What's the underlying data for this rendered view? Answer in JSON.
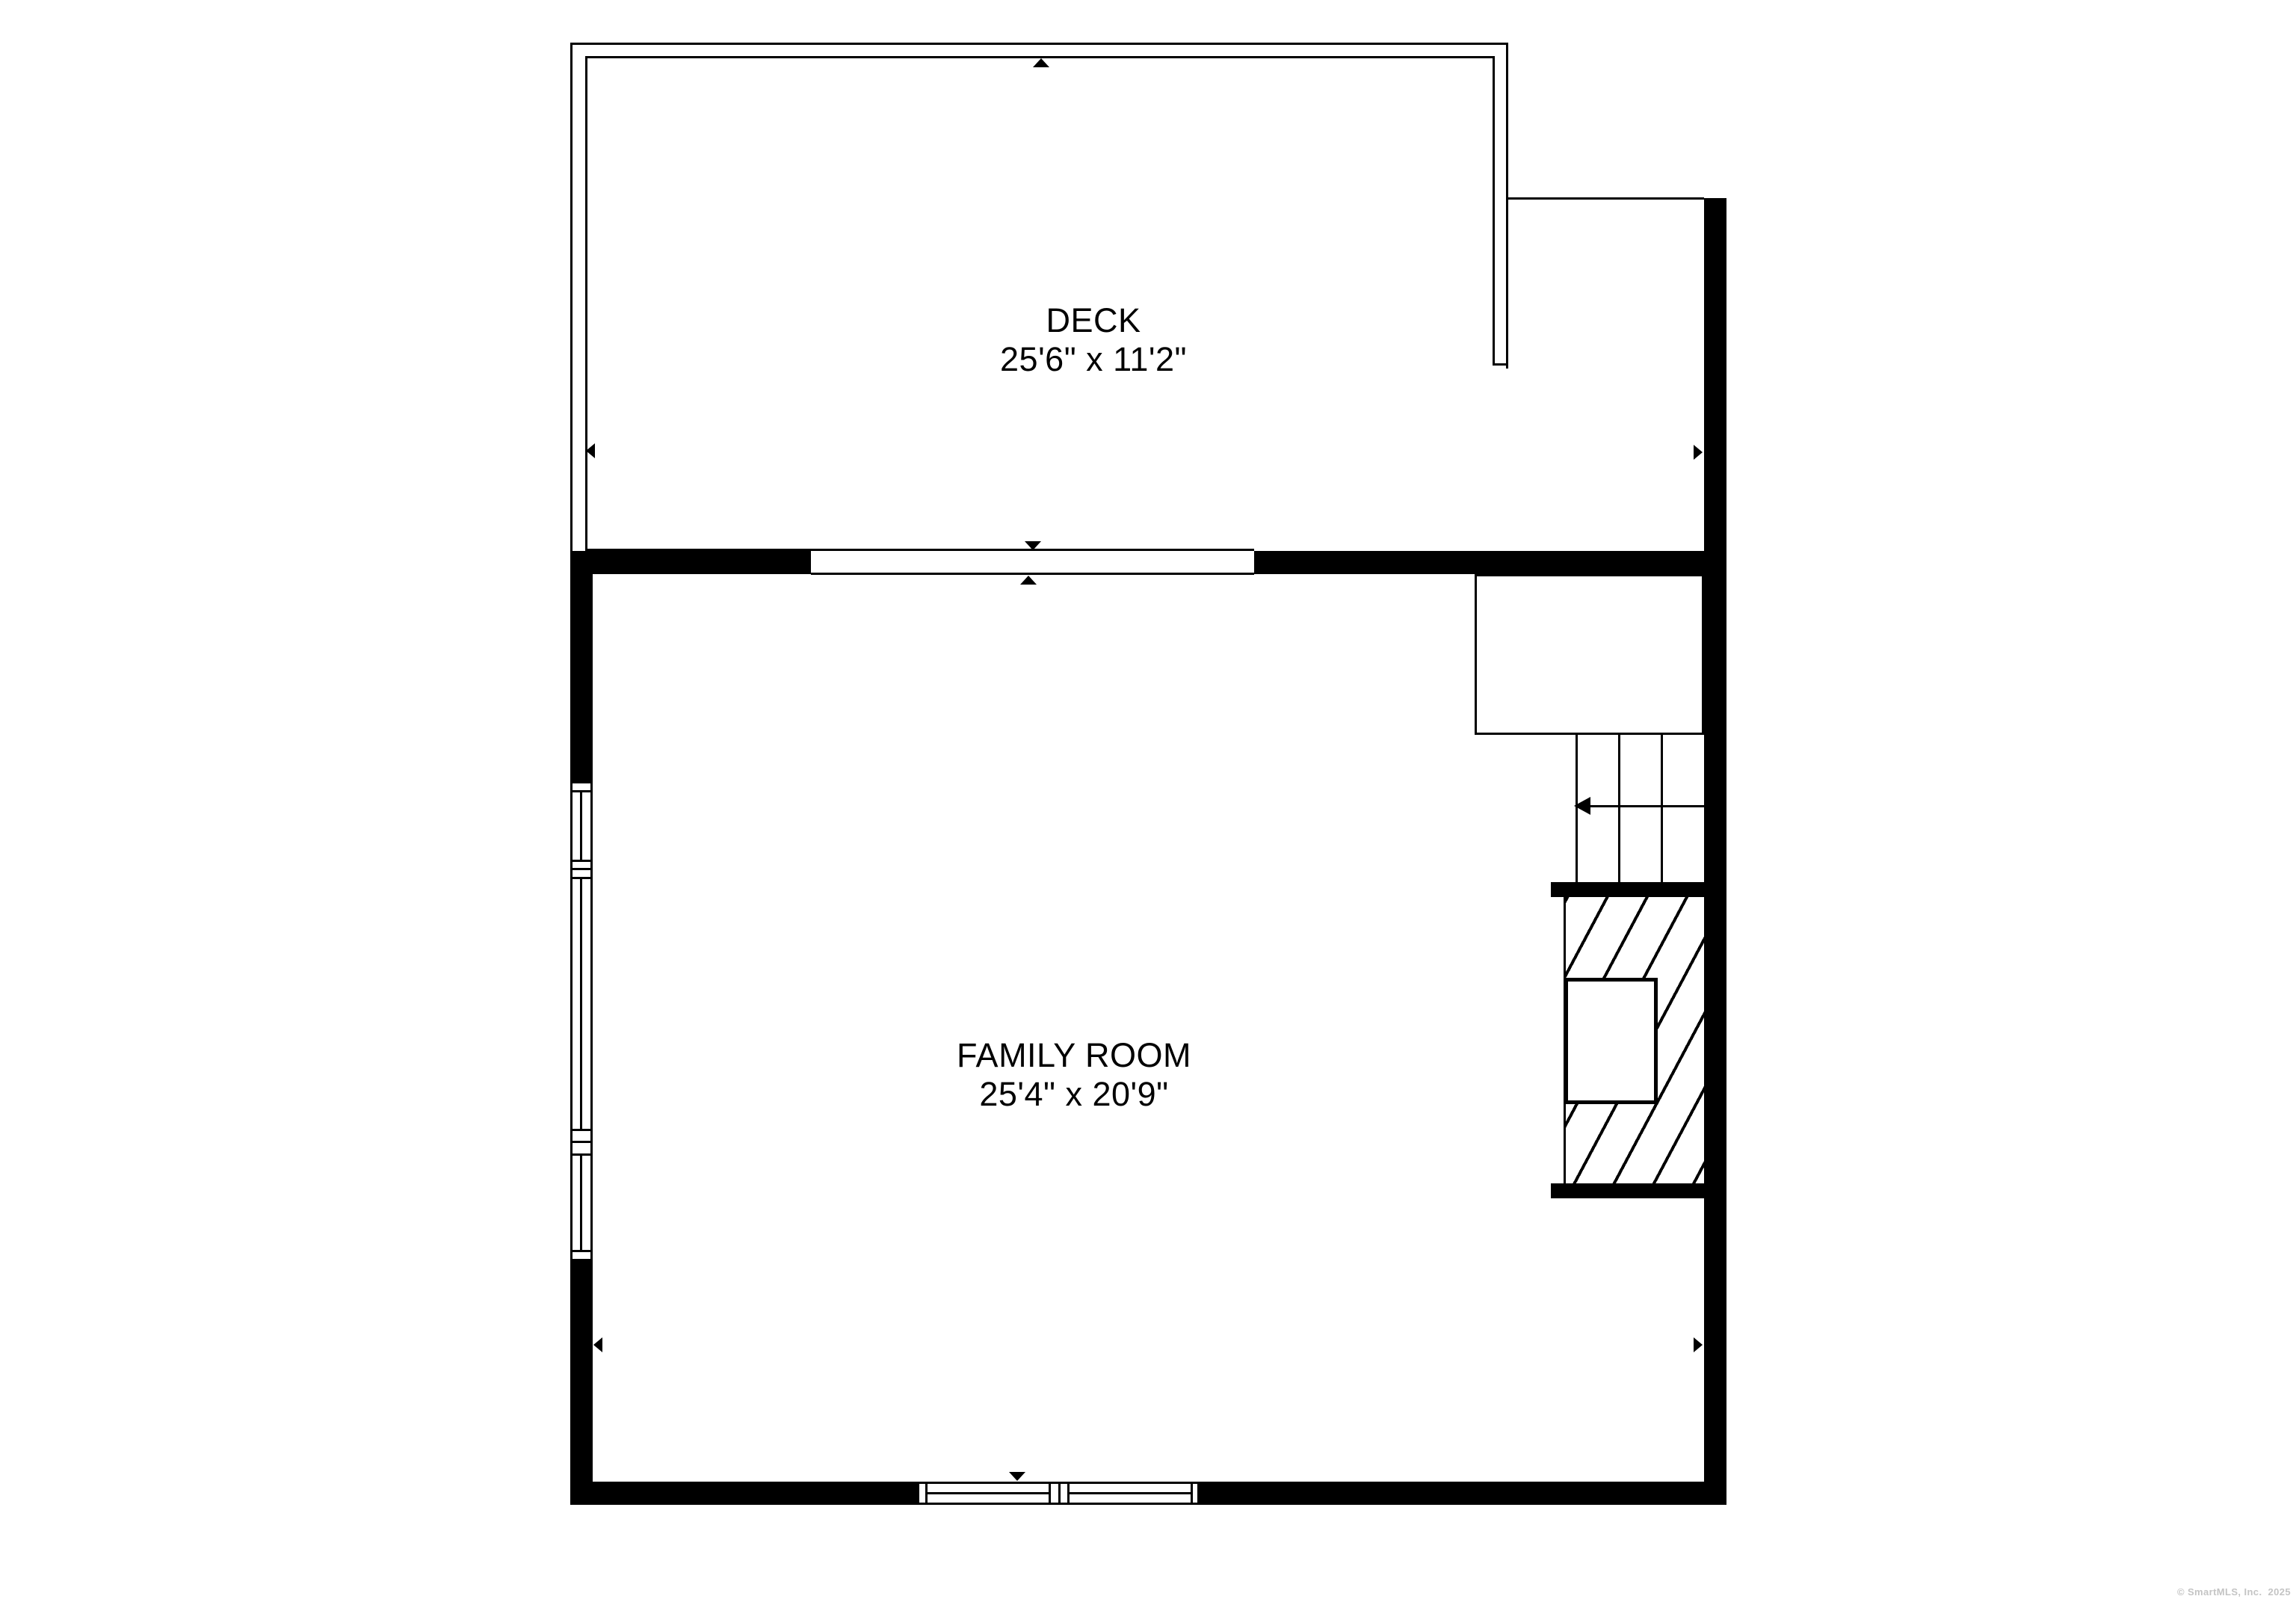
{
  "plan": {
    "rooms": [
      {
        "id": "deck",
        "name": "DECK",
        "dimensions": "25'6\" x 11'2\""
      },
      {
        "id": "family-room",
        "name": "FAMILY ROOM",
        "dimensions": "25'4\" x 20'9\""
      }
    ],
    "watermark": "© SmartMLS, Inc.  2025",
    "colors": {
      "wall": "#000000",
      "background": "#ffffff",
      "watermark_gray": "#c4c4c4"
    },
    "markers": {
      "deck_top_opening": "triangle-up-icon",
      "slider_exterior": "triangle-down-icon",
      "slider_interior": "triangle-up-icon",
      "bottom_window_marker": "triangle-down-icon",
      "deck_left_door": "triangle-left-icon",
      "upper_right_door": "triangle-right-icon",
      "room_left_door": "triangle-left-icon",
      "room_right_door": "triangle-right-icon",
      "stairs_direction": "arrow-left-icon"
    }
  }
}
